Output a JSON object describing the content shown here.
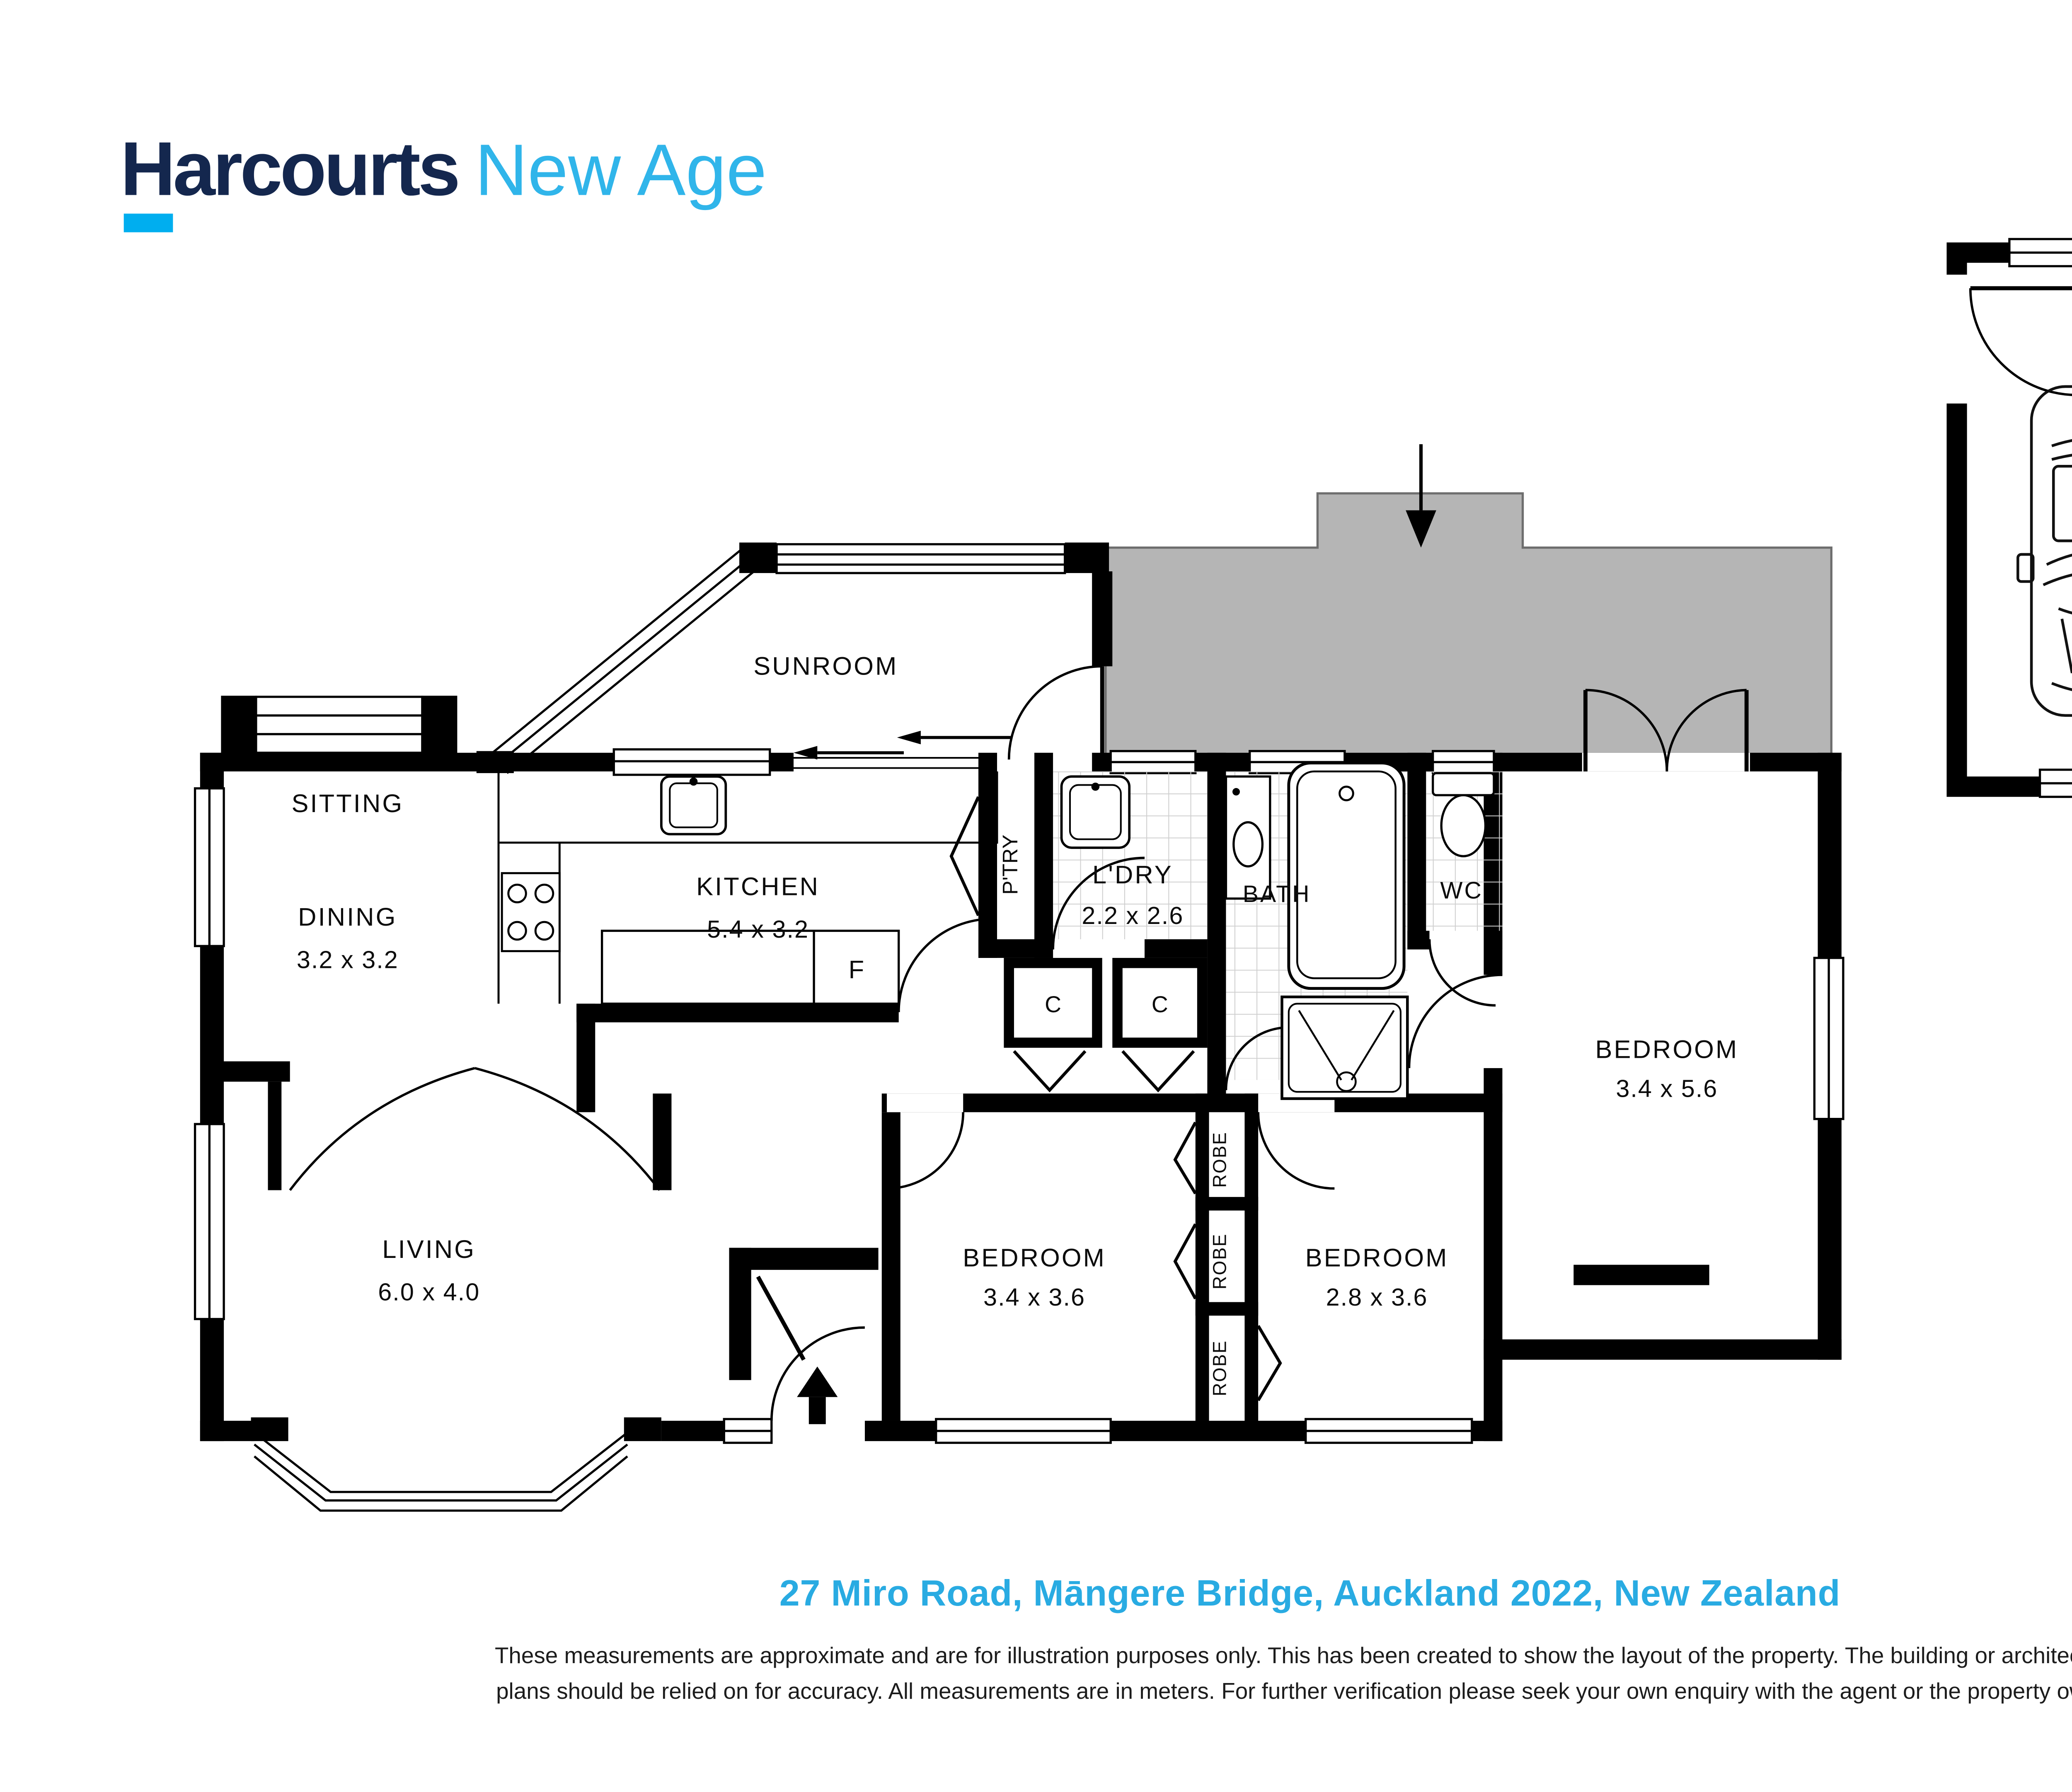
{
  "colors": {
    "brand_navy": "#14274e",
    "brand_bar_blue": "#00aeef",
    "brand_suffix_blue": "#30b5ea",
    "address_blue": "#29abe2",
    "deck_gray": "#b5b5b5",
    "wall_black": "#000000"
  },
  "brand": {
    "name": "Harcourts",
    "suffix": "New Age"
  },
  "plan": {
    "rooms": {
      "sitting": {
        "name": "SITTING"
      },
      "dining": {
        "name": "DINING",
        "dims": "3.2 x 3.2"
      },
      "kitchen": {
        "name": "KITCHEN",
        "dims": "5.4 x 3.2"
      },
      "sunroom": {
        "name": "SUNROOM"
      },
      "pantry": {
        "name": "P'TRY"
      },
      "laundry": {
        "name": "L'DRY",
        "dims": "2.2 x 2.6"
      },
      "bath": {
        "name": "BATH"
      },
      "wc": {
        "name": "WC"
      },
      "bedroom_rear": {
        "name": "BEDROOM",
        "dims": "3.4 x 5.6"
      },
      "bedroom_left": {
        "name": "BEDROOM",
        "dims": "3.4 x 3.6"
      },
      "bedroom_right": {
        "name": "BEDROOM",
        "dims": "2.8 x 3.6"
      },
      "living": {
        "name": "LIVING",
        "dims": "6.0 x 4.0"
      },
      "garage": {
        "name": "GARAGE",
        "dims": "5.4 x 5.8"
      }
    },
    "labels": {
      "robe": "ROBE",
      "closet": "C",
      "fridge": "F"
    },
    "fixtures": [
      "kitchen-sink",
      "stove",
      "laundry-sink",
      "vanity-basin",
      "bathtub",
      "shower",
      "toilet",
      "car",
      "car",
      "entry-arrow",
      "deck-entry-arrow",
      "sliding-door-arrows",
      "wardrobe"
    ]
  },
  "footer": {
    "address": "27 Miro Road, Māngere Bridge, Auckland 2022, New Zealand",
    "disclaimer_line1": "These measurements are approximate and are for illustration purposes only. This has been created to show the layout of the property. The building or architectural",
    "disclaimer_line2": "plans should be relied on for accuracy. All measurements are in meters. For further verification please seek your own enquiry with the agent or the property owner."
  }
}
